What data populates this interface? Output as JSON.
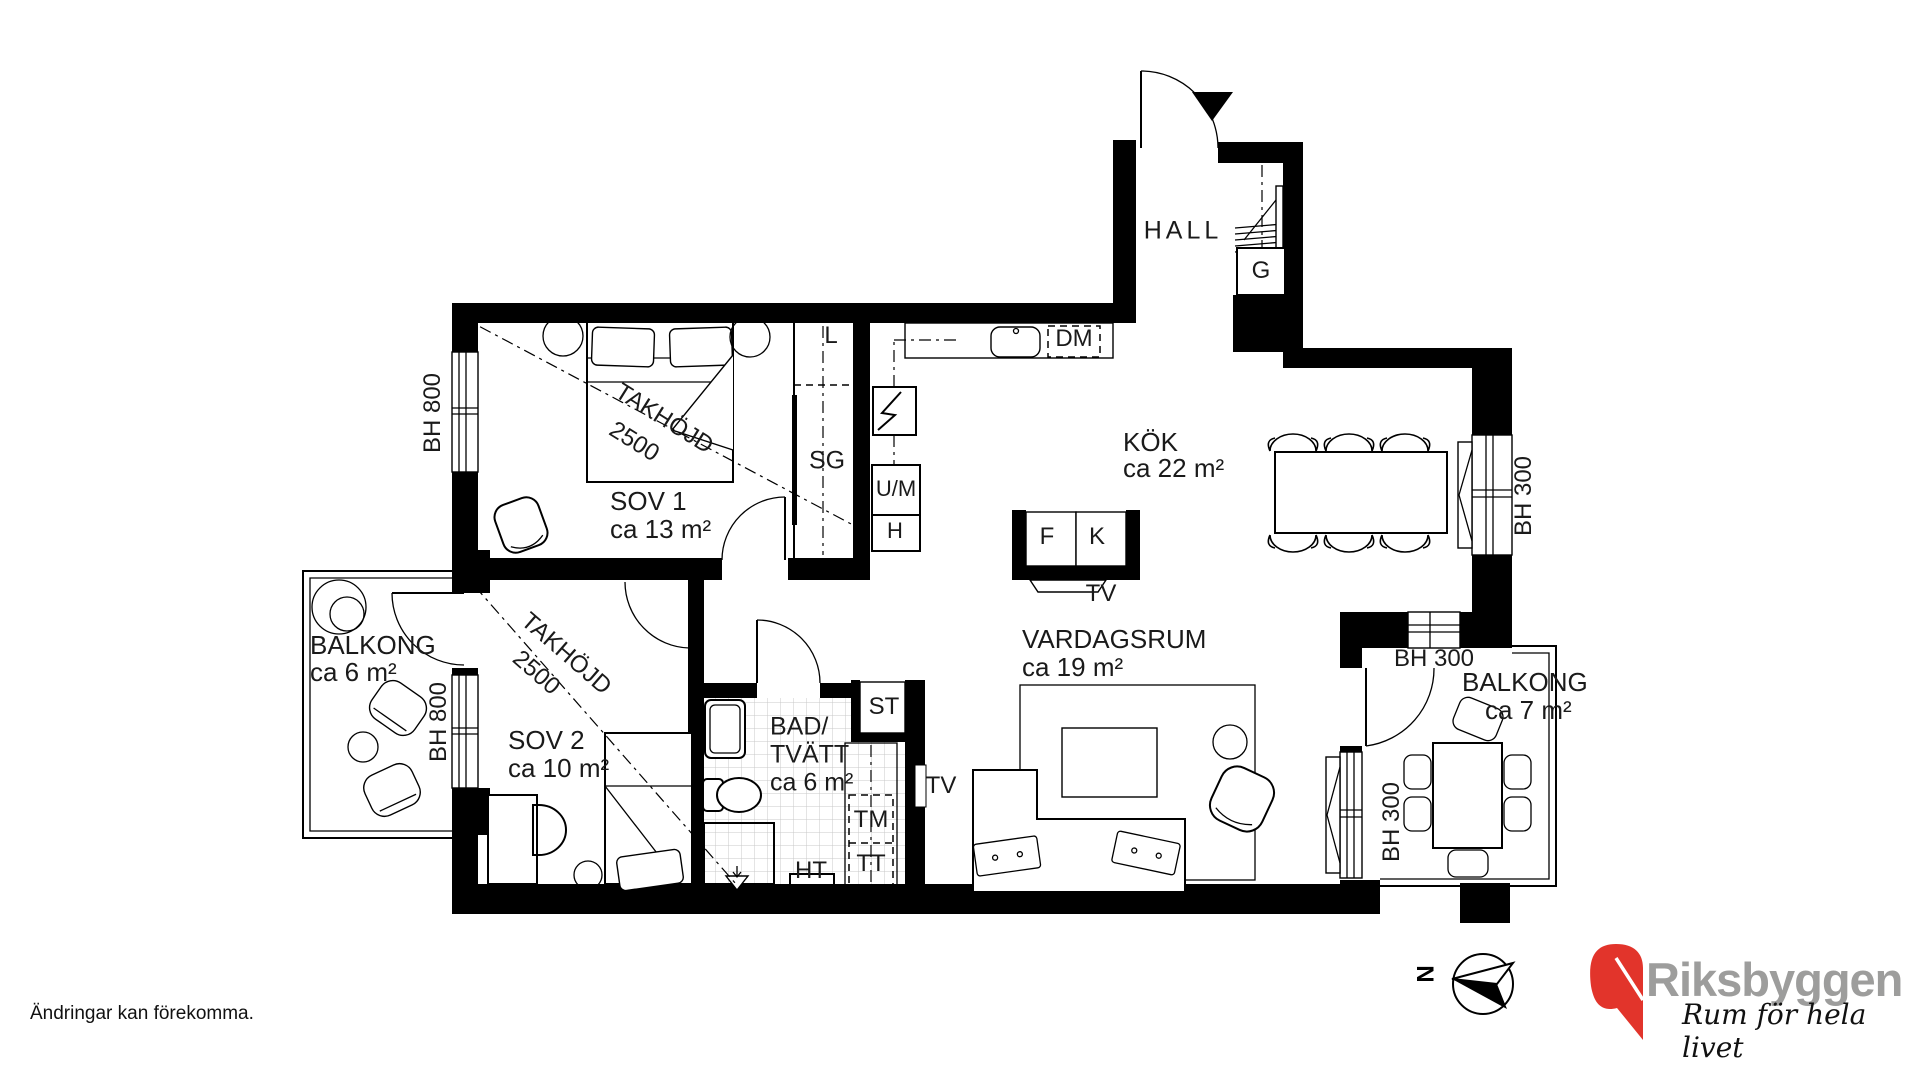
{
  "meta": {
    "disclaimer": "Ändringar kan förekomma.",
    "north_label": "N"
  },
  "brand": {
    "name": "Riksbyggen",
    "slogan": "Rum för hela livet",
    "red": "#E2342B",
    "gray": "#9D9D9C"
  },
  "rooms": [
    {
      "id": "hall",
      "name": "HALL",
      "area": ""
    },
    {
      "id": "kok",
      "name": "KÖK",
      "area": "ca 22 m²"
    },
    {
      "id": "sov1",
      "name": "SOV 1",
      "area": "ca 13 m²"
    },
    {
      "id": "sov2",
      "name": "SOV 2",
      "area": "ca 10 m²"
    },
    {
      "id": "bad-tvatt",
      "name": "BAD/TVÄTT",
      "area": "ca 6 m²"
    },
    {
      "id": "vardagsrum",
      "name": "VARDAGSRUM",
      "area": "ca 19 m²"
    },
    {
      "id": "balkong-vast",
      "name": "BALKONG",
      "area": "ca 6 m²"
    },
    {
      "id": "balkong-ost",
      "name": "BALKONG",
      "area": "ca 7 m²"
    }
  ],
  "fixture_codes": [
    "L",
    "SG",
    "U/M",
    "H",
    "DM",
    "G",
    "F",
    "K",
    "TV",
    "ST",
    "TM",
    "TT",
    "HT"
  ],
  "dimension_notes": [
    "TAKHÖJD 2500",
    "BH 800",
    "BH 300"
  ],
  "labels": [
    {
      "id": "room-hall",
      "text": "HALL",
      "x": 1183,
      "y": 231,
      "size": 25,
      "rot": 0,
      "anchor": "c",
      "ls": 4
    },
    {
      "id": "room-kok",
      "text": "KÖK",
      "x": 1123,
      "y": 442,
      "size": 26,
      "rot": 0,
      "anchor": "l",
      "ls": 0
    },
    {
      "id": "room-kok-area",
      "text": "ca 22 m²",
      "x": 1123,
      "y": 468,
      "size": 26,
      "rot": 0,
      "anchor": "l",
      "ls": 0
    },
    {
      "id": "room-sov1",
      "text": "SOV 1",
      "x": 610,
      "y": 501,
      "size": 26,
      "rot": 0,
      "anchor": "l",
      "ls": 0
    },
    {
      "id": "room-sov1-area",
      "text": "ca 13 m²",
      "x": 610,
      "y": 529,
      "size": 26,
      "rot": 0,
      "anchor": "l",
      "ls": 0
    },
    {
      "id": "dim-takhojd-sov1",
      "text": "TAKHÖJD",
      "x": 664,
      "y": 419,
      "size": 24,
      "rot": 32,
      "anchor": "c",
      "ls": 0
    },
    {
      "id": "dim-takhojd-sov1-2",
      "text": "2500",
      "x": 634,
      "y": 442,
      "size": 24,
      "rot": 32,
      "anchor": "c",
      "ls": 0
    },
    {
      "id": "room-sov2",
      "text": "SOV 2",
      "x": 508,
      "y": 740,
      "size": 26,
      "rot": 0,
      "anchor": "l",
      "ls": 0
    },
    {
      "id": "room-sov2-area",
      "text": "ca 10 m²",
      "x": 508,
      "y": 768,
      "size": 26,
      "rot": 0,
      "anchor": "l",
      "ls": 0
    },
    {
      "id": "dim-takhojd-sov2",
      "text": "TAKHÖJD",
      "x": 566,
      "y": 654,
      "size": 24,
      "rot": 41,
      "anchor": "c",
      "ls": 0
    },
    {
      "id": "dim-takhojd-sov2-2",
      "text": "2500",
      "x": 536,
      "y": 673,
      "size": 24,
      "rot": 41,
      "anchor": "c",
      "ls": 0
    },
    {
      "id": "room-bad",
      "text": "BAD/",
      "x": 770,
      "y": 727,
      "size": 25,
      "rot": 0,
      "anchor": "l",
      "ls": 0
    },
    {
      "id": "room-bad-2",
      "text": "TVÄTT",
      "x": 770,
      "y": 755,
      "size": 25,
      "rot": 0,
      "anchor": "l",
      "ls": 0
    },
    {
      "id": "room-bad-area",
      "text": "ca 6 m²",
      "x": 770,
      "y": 783,
      "size": 25,
      "rot": 0,
      "anchor": "l",
      "ls": 0
    },
    {
      "id": "room-vardagsrum",
      "text": "VARDAGSRUM",
      "x": 1022,
      "y": 639,
      "size": 26,
      "rot": 0,
      "anchor": "l",
      "ls": 0
    },
    {
      "id": "room-vardagsrum-area",
      "text": "ca 19 m²",
      "x": 1022,
      "y": 667,
      "size": 26,
      "rot": 0,
      "anchor": "l",
      "ls": 0
    },
    {
      "id": "room-balkong-v",
      "text": "BALKONG",
      "x": 310,
      "y": 645,
      "size": 26,
      "rot": 0,
      "anchor": "l",
      "ls": 0
    },
    {
      "id": "room-balkong-v-area",
      "text": "ca 6 m²",
      "x": 310,
      "y": 672,
      "size": 26,
      "rot": 0,
      "anchor": "l",
      "ls": 0
    },
    {
      "id": "room-balkong-o",
      "text": "BALKONG",
      "x": 1462,
      "y": 682,
      "size": 26,
      "rot": 0,
      "anchor": "l",
      "ls": 0
    },
    {
      "id": "room-balkong-o-area",
      "text": "ca 7 m²",
      "x": 1485,
      "y": 710,
      "size": 26,
      "rot": 0,
      "anchor": "l",
      "ls": 0
    },
    {
      "id": "dim-bh300-topp",
      "text": "BH 300",
      "x": 1434,
      "y": 659,
      "size": 24,
      "rot": 0,
      "anchor": "c",
      "ls": 0
    },
    {
      "id": "dim-bh300-vast",
      "text": "BH 300",
      "x": 1392,
      "y": 822,
      "size": 24,
      "rot": -90,
      "anchor": "c",
      "ls": 0
    },
    {
      "id": "dim-bh300-ost",
      "text": "BH 300",
      "x": 1524,
      "y": 496,
      "size": 24,
      "rot": -90,
      "anchor": "c",
      "ls": 0
    },
    {
      "id": "dim-bh800-sov1",
      "text": "BH 800",
      "x": 433,
      "y": 413,
      "size": 24,
      "rot": -90,
      "anchor": "c",
      "ls": 0
    },
    {
      "id": "dim-bh800-sov2",
      "text": "BH 800",
      "x": 439,
      "y": 722,
      "size": 24,
      "rot": -90,
      "anchor": "c",
      "ls": 0
    },
    {
      "id": "fix-l",
      "text": "L",
      "x": 831,
      "y": 336,
      "size": 24,
      "rot": 0,
      "anchor": "c",
      "ls": 0
    },
    {
      "id": "fix-sg",
      "text": "SG",
      "x": 827,
      "y": 461,
      "size": 25,
      "rot": 0,
      "anchor": "c",
      "ls": 0
    },
    {
      "id": "fix-um",
      "text": "U/M",
      "x": 896,
      "y": 489,
      "size": 22,
      "rot": 0,
      "anchor": "c",
      "ls": 0
    },
    {
      "id": "fix-h",
      "text": "H",
      "x": 895,
      "y": 531,
      "size": 22,
      "rot": 0,
      "anchor": "c",
      "ls": 0
    },
    {
      "id": "fix-dm",
      "text": "DM",
      "x": 1074,
      "y": 339,
      "size": 24,
      "rot": 0,
      "anchor": "c",
      "ls": 0
    },
    {
      "id": "fix-g",
      "text": "G",
      "x": 1261,
      "y": 271,
      "size": 24,
      "rot": 0,
      "anchor": "c",
      "ls": 0
    },
    {
      "id": "fix-f",
      "text": "F",
      "x": 1047,
      "y": 537,
      "size": 24,
      "rot": 0,
      "anchor": "c",
      "ls": 0
    },
    {
      "id": "fix-k",
      "text": "K",
      "x": 1097,
      "y": 537,
      "size": 24,
      "rot": 0,
      "anchor": "c",
      "ls": 0
    },
    {
      "id": "fix-tv-kok",
      "text": "TV",
      "x": 1101,
      "y": 594,
      "size": 24,
      "rot": 0,
      "anchor": "c",
      "ls": 0
    },
    {
      "id": "fix-st",
      "text": "ST",
      "x": 884,
      "y": 707,
      "size": 24,
      "rot": 0,
      "anchor": "c",
      "ls": 0
    },
    {
      "id": "fix-tm",
      "text": "TM",
      "x": 871,
      "y": 820,
      "size": 24,
      "rot": 0,
      "anchor": "c",
      "ls": 0
    },
    {
      "id": "fix-tt",
      "text": "TT",
      "x": 871,
      "y": 864,
      "size": 24,
      "rot": 0,
      "anchor": "c",
      "ls": 0
    },
    {
      "id": "fix-ht",
      "text": "HT",
      "x": 811,
      "y": 871,
      "size": 24,
      "rot": 0,
      "anchor": "c",
      "ls": 0
    },
    {
      "id": "fix-tv-vard",
      "text": "TV",
      "x": 941,
      "y": 786,
      "size": 24,
      "rot": 0,
      "anchor": "c",
      "ls": 0
    }
  ]
}
